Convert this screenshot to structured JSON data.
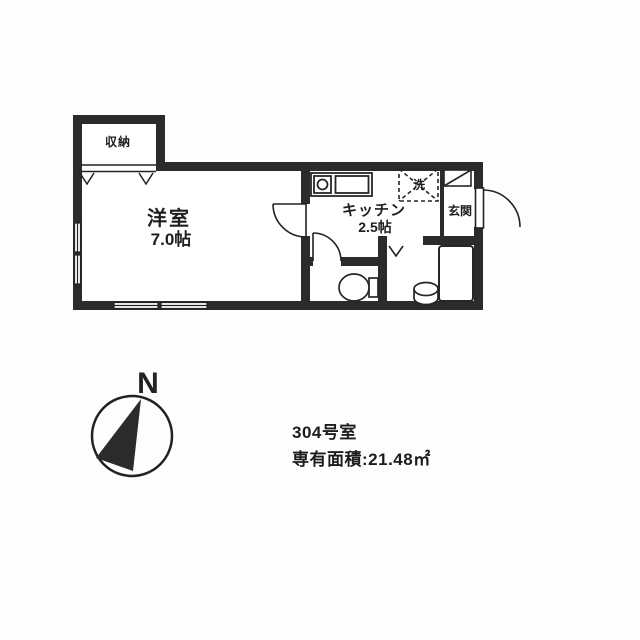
{
  "plan": {
    "rooms": {
      "closet": "収納",
      "western_room": "洋室",
      "western_room_size": "7.0帖",
      "kitchen": "キッチン",
      "kitchen_size": "2.5帖",
      "entrance": "玄関",
      "laundry": "洗"
    },
    "compass_label": "N",
    "caption_line1": "304号室",
    "caption_line2": "専有面積:21.48㎡"
  },
  "colors": {
    "wall": "#2b2b2b",
    "line": "#222222",
    "background": "#fdfdfd",
    "floor": "#ffffff"
  }
}
